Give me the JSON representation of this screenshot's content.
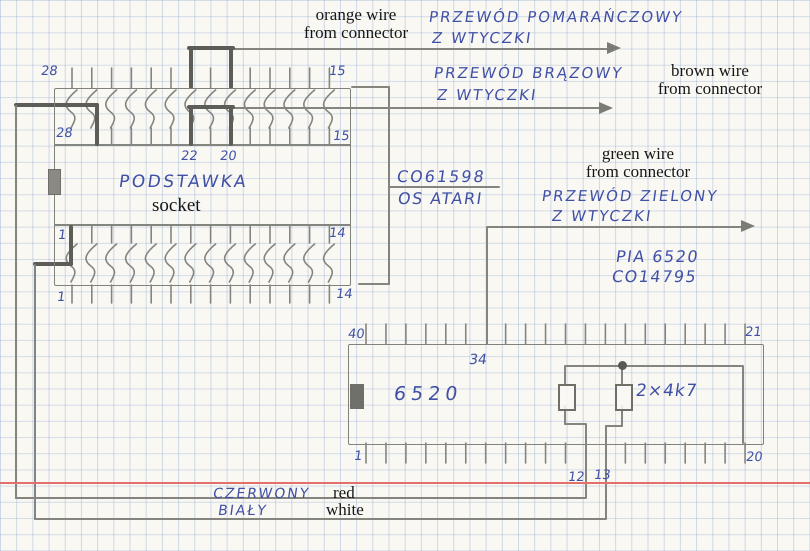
{
  "colors": {
    "ink": "#4050a5",
    "pencil": "#85857f",
    "pencil_dark": "#5d5d57",
    "margin_line": "#e4706b",
    "paper": "#f9f8f3"
  },
  "socket": {
    "name_pl": "PODSTAWKA",
    "name_en": "socket",
    "pins_per_row": 14,
    "pin_labels": {
      "top_left": "28",
      "top_right": "15",
      "row2_left": "28",
      "row2_right": "15",
      "jumper_left": "22",
      "jumper_right": "20",
      "row3_left": "1",
      "row3_right": "14",
      "bottom_left": "1",
      "bottom_right": "14"
    }
  },
  "chip_id": {
    "part_number": "CO61598",
    "platform": "OS ATARI"
  },
  "pia": {
    "title": "PIA 6520",
    "part_number": "CO14795",
    "chip_label": "6520",
    "resistor_label": "2×4k7",
    "pins_per_row": 20,
    "pin_labels": {
      "top_left": "40",
      "top_right": "21",
      "bottom_left": "1",
      "bottom_right": "20",
      "pin34": "34",
      "pin12": "12",
      "pin13": "13"
    }
  },
  "wires": {
    "orange": {
      "pl_line1": "PRZEWÓD POMARAŃCZOWY",
      "pl_line2": "Z WTYCZKI",
      "en_line1": "orange wire",
      "en_line2": "from connector"
    },
    "brown": {
      "pl_line1": "PRZEWÓD BRĄZOWY",
      "pl_line2": "Z WTYCZKI",
      "en_line1": "brown wire",
      "en_line2": "from connector"
    },
    "green": {
      "pl_line1": "PRZEWÓD ZIELONY",
      "pl_line2": "Z WTYCZKI",
      "en_line1": "green wire",
      "en_line2": "from connector"
    },
    "red": {
      "pl": "CZERWONY",
      "en": "red"
    },
    "white": {
      "pl": "BIAŁY",
      "en": "white"
    }
  }
}
